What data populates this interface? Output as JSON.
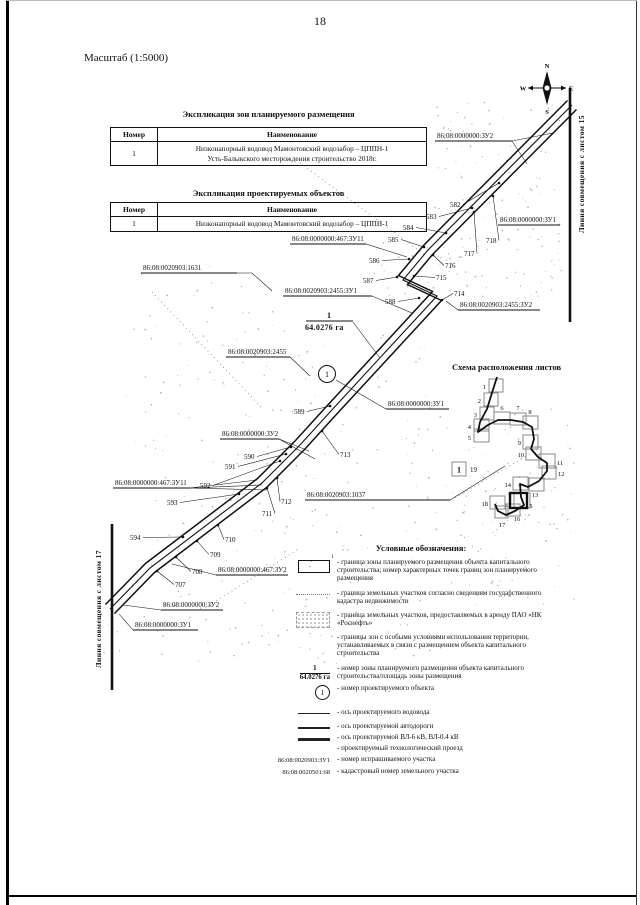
{
  "page": {
    "number": "18",
    "scale_label": "Масштаб (1:5000)",
    "paper": "#ffffff",
    "ink": "#111111"
  },
  "compass": {
    "n": "N",
    "s": "S",
    "w": "W",
    "e": "E"
  },
  "tables": [
    {
      "title": "Экспликация зон планируемого размещения",
      "headers": [
        "Номер",
        "Наименование"
      ],
      "rows": [
        {
          "num": "1",
          "name_lines": [
            "Низконапорный водовод Мамонтовский водозабор – ЦППН-1",
            "Усть-Балыкского месторождения строительство 2018г."
          ]
        }
      ]
    },
    {
      "title": "Экспликация проектируемых объектов",
      "headers": [
        "Номер",
        "Наименование"
      ],
      "rows": [
        {
          "num": "1",
          "name_lines": [
            "Низконапорный водовод Мамонтовский водозабор – ЦППН-1"
          ]
        }
      ]
    }
  ],
  "map": {
    "edge_right_label": "Линия совмещения с листом 15",
    "edge_left_label": "Линия совмещения с листом 17",
    "zone_number": "1",
    "zone_area": "64.0276 га",
    "object_number": "1",
    "pipeline_axis": [
      [
        572,
        105
      ],
      [
        428,
        250
      ],
      [
        403,
        280
      ],
      [
        437,
        296
      ],
      [
        330,
        412
      ],
      [
        300,
        445
      ],
      [
        262,
        483
      ],
      [
        150,
        568
      ],
      [
        110,
        609
      ]
    ],
    "points": [
      {
        "n": "582",
        "x": 450,
        "y": 207,
        "tx": 499,
        "ty": 183
      },
      {
        "n": "583",
        "x": 426,
        "y": 219,
        "tx": 472,
        "ty": 208
      },
      {
        "n": "584",
        "x": 403,
        "y": 230,
        "tx": 446,
        "ty": 233
      },
      {
        "n": "585",
        "x": 388,
        "y": 242,
        "tx": 424,
        "ty": 247
      },
      {
        "n": "586",
        "x": 369,
        "y": 263,
        "tx": 409,
        "ty": 259
      },
      {
        "n": "587",
        "x": 363,
        "y": 283,
        "tx": 397,
        "ty": 277
      },
      {
        "n": "588",
        "x": 385,
        "y": 304,
        "tx": 419,
        "ty": 298
      },
      {
        "n": "589",
        "x": 294,
        "y": 414,
        "tx": 330,
        "ty": 406
      },
      {
        "n": "590",
        "x": 244,
        "y": 459,
        "tx": 291,
        "ty": 447
      },
      {
        "n": "591",
        "x": 225,
        "y": 469,
        "tx": 286,
        "ty": 454
      },
      {
        "n": "592",
        "x": 200,
        "y": 488,
        "tx": 280,
        "ty": 461
      },
      {
        "n": "593",
        "x": 167,
        "y": 505,
        "tx": 239,
        "ty": 494
      },
      {
        "n": "594",
        "x": 130,
        "y": 540,
        "tx": 183,
        "ty": 537
      },
      {
        "n": "718",
        "x": 486,
        "y": 243,
        "tx": 493,
        "ty": 196
      },
      {
        "n": "717",
        "x": 464,
        "y": 256,
        "tx": 474,
        "ty": 212
      },
      {
        "n": "716",
        "x": 445,
        "y": 268,
        "tx": 433,
        "ty": 255
      },
      {
        "n": "715",
        "x": 436,
        "y": 280,
        "tx": 414,
        "ty": 276
      },
      {
        "n": "714",
        "x": 454,
        "y": 296,
        "tx": 442,
        "ty": 300
      },
      {
        "n": "713",
        "x": 340,
        "y": 457,
        "tx": 322,
        "ty": 431
      },
      {
        "n": "712",
        "x": 281,
        "y": 504,
        "tx": 277,
        "ty": 478
      },
      {
        "n": "711",
        "x": 262,
        "y": 516,
        "tx": 267,
        "ty": 488
      },
      {
        "n": "710",
        "x": 225,
        "y": 542,
        "tx": 218,
        "ty": 525
      },
      {
        "n": "709",
        "x": 210,
        "y": 557,
        "tx": 197,
        "ty": 541
      },
      {
        "n": "708",
        "x": 192,
        "y": 574,
        "tx": 176,
        "ty": 557
      },
      {
        "n": "707",
        "x": 175,
        "y": 587,
        "tx": 157,
        "ty": 571
      }
    ],
    "cad_labels": [
      {
        "t": "86:08:0000000:ЗУ2",
        "x": 437,
        "y": 138,
        "u": [
          435,
          141,
          512,
          141
        ],
        "leaders": [
          [
            [
              512,
              141
            ],
            [
              553,
              133
            ]
          ],
          [
            [
              512,
              141
            ],
            [
              527,
              164
            ]
          ]
        ]
      },
      {
        "t": "86:08:0000000:ЗУ1",
        "x": 500,
        "y": 222,
        "u": [
          498,
          225,
          560,
          225
        ],
        "leaders": []
      },
      {
        "t": "86:08:0000000:467:ЗУ11",
        "x": 292,
        "y": 241,
        "u": [
          290,
          244,
          366,
          244
        ],
        "leaders": [
          [
            [
              366,
              244
            ],
            [
              407,
              257
            ]
          ]
        ]
      },
      {
        "t": "86:08:0020903:1631",
        "x": 143,
        "y": 270,
        "u": [
          141,
          273,
          237,
          273
        ],
        "leaders": [
          [
            [
              237,
              273
            ],
            [
              252,
              273
            ],
            [
              272,
              291
            ]
          ]
        ]
      },
      {
        "t": "86:08:0020903:2455:ЗУ1",
        "x": 285,
        "y": 293,
        "u": [
          283,
          296,
          372,
          296
        ],
        "leaders": [
          [
            [
              372,
              296
            ],
            [
              412,
              313
            ]
          ]
        ]
      },
      {
        "t": "86:08:0020903:2455:ЗУ2",
        "x": 460,
        "y": 307,
        "u": [
          458,
          310,
          540,
          310
        ],
        "leaders": [
          [
            [
              458,
              310
            ],
            [
              446,
              301
            ]
          ]
        ]
      },
      {
        "t": "86:08:0020903:2455",
        "x": 228,
        "y": 354,
        "u": [
          226,
          357,
          290,
          357
        ],
        "leaders": [
          [
            [
              290,
              357
            ],
            [
              310,
              376
            ]
          ]
        ]
      },
      {
        "t": "86:08:0000000:ЗУ1",
        "x": 388,
        "y": 406,
        "u": [
          386,
          409,
          449,
          409
        ],
        "leaders": [
          [
            [
              386,
              409
            ],
            [
              336,
              380
            ]
          ]
        ]
      },
      {
        "t": "86:08:0000000:ЗУ2",
        "x": 222,
        "y": 436,
        "u": [
          220,
          439,
          279,
          439
        ],
        "leaders": [
          [
            [
              279,
              439
            ],
            [
              309,
              451
            ]
          ],
          [
            [
              279,
              439
            ],
            [
              315,
              459
            ]
          ]
        ]
      },
      {
        "t": "86:08:0020903:1037",
        "x": 307,
        "y": 497,
        "u": [
          305,
          500,
          450,
          500
        ],
        "leaders": [
          [
            [
              450,
              500
            ],
            [
              505,
              466
            ]
          ]
        ]
      },
      {
        "t": "86:08:0000000:467:ЗУ11",
        "x": 115,
        "y": 485,
        "u": [
          113,
          488,
          190,
          488
        ],
        "leaders": [
          [
            [
              190,
              488
            ],
            [
              257,
              480
            ]
          ],
          [
            [
              190,
              488
            ],
            [
              262,
              485
            ]
          ],
          [
            [
              190,
              488
            ],
            [
              267,
              490
            ]
          ]
        ]
      },
      {
        "t": "86:08:0000000:467:ЗУ2",
        "x": 218,
        "y": 572,
        "u": [
          216,
          575,
          288,
          575
        ],
        "leaders": [
          [
            [
              216,
              575
            ],
            [
              172,
              564
            ]
          ]
        ]
      },
      {
        "t": "86:08:0000000:ЗУ2",
        "x": 163,
        "y": 607,
        "u": [
          161,
          610,
          223,
          610
        ],
        "leaders": [
          [
            [
              161,
              610
            ],
            [
              123,
              605
            ]
          ]
        ]
      },
      {
        "t": "86:08:0000000:ЗУ1",
        "x": 135,
        "y": 627,
        "u": [
          133,
          630,
          198,
          630
        ],
        "leaders": [
          [
            [
              133,
              630
            ],
            [
              119,
              614
            ]
          ]
        ]
      }
    ],
    "fraction_pos": {
      "nx": 329,
      "ny": 318,
      "bar": [
        306,
        321,
        353,
        321
      ],
      "dx": 305,
      "dy": 330,
      "leader": [
        [
          353,
          322
        ],
        [
          380,
          358
        ]
      ]
    },
    "object_circle": {
      "cx": 327,
      "cy": 374,
      "r": 8.5
    },
    "speckle_regions": [
      [
        432,
        100,
        130,
        200,
        120
      ],
      [
        370,
        240,
        90,
        60,
        25
      ],
      [
        125,
        260,
        160,
        210,
        70
      ],
      [
        255,
        335,
        175,
        150,
        60
      ],
      [
        395,
        405,
        180,
        200,
        100
      ],
      [
        145,
        475,
        230,
        170,
        80
      ],
      [
        95,
        612,
        360,
        55,
        45
      ],
      [
        455,
        505,
        100,
        45,
        22
      ]
    ],
    "dotted_lines": [
      [
        [
          300,
          163
        ],
        [
          425,
          255
        ]
      ],
      [
        [
          152,
          292
        ],
        [
          262,
          408
        ]
      ],
      [
        [
          455,
          498
        ],
        [
          540,
          448
        ]
      ],
      [
        [
          205,
          608
        ],
        [
          300,
          548
        ]
      ]
    ],
    "edge_right_line": [
      570,
      88,
      570,
      322
    ],
    "edge_left_line": [
      112,
      524,
      112,
      690
    ]
  },
  "scheme": {
    "title": "Схема расположения листов",
    "sheets": [
      {
        "n": "1",
        "x": 489,
        "y": 379,
        "w": 14,
        "h": 13,
        "lx": 486,
        "ly": 389,
        "a": "end"
      },
      {
        "n": "2",
        "x": 484,
        "y": 393,
        "w": 14,
        "h": 13,
        "lx": 481,
        "ly": 403,
        "a": "end"
      },
      {
        "n": "3",
        "x": 480,
        "y": 407,
        "w": 14,
        "h": 13,
        "lx": 477,
        "ly": 417,
        "a": "end"
      },
      {
        "n": "4",
        "x": 474,
        "y": 419,
        "w": 15,
        "h": 12,
        "lx": 471,
        "ly": 429,
        "a": "end"
      },
      {
        "n": "5",
        "x": 474,
        "y": 429,
        "w": 15,
        "h": 13,
        "lx": 471,
        "ly": 440,
        "a": "end"
      },
      {
        "n": "6",
        "x": 494,
        "y": 412,
        "w": 16,
        "h": 12,
        "lx": 502,
        "ly": 410,
        "a": "middle"
      },
      {
        "n": "7",
        "x": 510,
        "y": 413,
        "w": 16,
        "h": 12,
        "lx": 518,
        "ly": 410,
        "a": "middle"
      },
      {
        "n": "8",
        "x": 523,
        "y": 416,
        "w": 15,
        "h": 13,
        "lx": 530,
        "ly": 414,
        "a": "middle"
      },
      {
        "n": "9",
        "x": 523,
        "y": 435,
        "w": 15,
        "h": 14,
        "lx": 521,
        "ly": 445,
        "a": "end"
      },
      {
        "n": "10",
        "x": 526,
        "y": 447,
        "w": 15,
        "h": 13,
        "lx": 524,
        "ly": 457,
        "a": "end"
      },
      {
        "n": "11",
        "x": 539,
        "y": 454,
        "w": 16,
        "h": 14,
        "lx": 557,
        "ly": 465,
        "a": "start"
      },
      {
        "n": "12",
        "x": 542,
        "y": 466,
        "w": 14,
        "h": 13,
        "lx": 558,
        "ly": 476,
        "a": "start"
      },
      {
        "n": "13",
        "x": 529,
        "y": 478,
        "w": 15,
        "h": 13,
        "lx": 535,
        "ly": 497,
        "a": "middle"
      },
      {
        "n": "14",
        "x": 513,
        "y": 477,
        "w": 15,
        "h": 13,
        "lx": 511,
        "ly": 487,
        "a": "end"
      },
      {
        "n": "15",
        "x": 514,
        "y": 493,
        "w": 16,
        "h": 15,
        "lx": 526,
        "ly": 508,
        "a": "start"
      },
      {
        "n": "16",
        "x": 506,
        "y": 504,
        "w": 14,
        "h": 12,
        "lx": 517,
        "ly": 521,
        "a": "middle"
      },
      {
        "n": "17",
        "x": 495,
        "y": 506,
        "w": 13,
        "h": 12,
        "lx": 502,
        "ly": 527,
        "a": "middle"
      },
      {
        "n": "18",
        "x": 490,
        "y": 496,
        "w": 15,
        "h": 13,
        "lx": 488,
        "ly": 506,
        "a": "end"
      }
    ],
    "bold_box": {
      "x": 510,
      "y": 493,
      "w": 17,
      "h": 15
    },
    "route": [
      [
        497,
        377
      ],
      [
        491,
        396
      ],
      [
        487,
        409
      ],
      [
        480,
        422
      ],
      [
        478,
        432
      ],
      [
        488,
        425
      ],
      [
        498,
        420
      ],
      [
        511,
        420
      ],
      [
        523,
        422
      ],
      [
        532,
        427
      ],
      [
        534,
        439
      ],
      [
        531,
        449
      ],
      [
        538,
        457
      ],
      [
        547,
        463
      ],
      [
        547,
        471
      ],
      [
        539,
        481
      ],
      [
        528,
        487
      ],
      [
        520,
        484
      ],
      [
        521,
        497
      ],
      [
        524,
        505
      ],
      [
        515,
        511
      ],
      [
        506,
        515
      ],
      [
        498,
        511
      ],
      [
        495,
        504
      ]
    ],
    "legend_box": {
      "x": 452,
      "y": 462,
      "w": 14,
      "h": 14,
      "mark": "1",
      "label": "19"
    }
  },
  "legend": {
    "title": "Условные обозначения:",
    "items": [
      {
        "sym": "zone",
        "text": "граница зоны планируемого размещения объекта капитального строительства; номер характерных точек границ зон планируемого размещения",
        "mb": 8
      },
      {
        "sym": "dots",
        "text": "граница земельных участков согласно сведениям государственного кадастра недвижимости",
        "mb": 6
      },
      {
        "sym": "speckle",
        "text": "граница земельных участков, предоставляемых в аренду ПАО «НК «Роснефть»",
        "mb": 6
      },
      {
        "sym": "none",
        "text": "границы зон с особыми условиями использования территории, устанавливаемых в связи с размещением объекта капитального строительства",
        "mb": 8
      },
      {
        "sym": "frac",
        "text": "номер зоны планируемого размещения объекта капитального строительства/площадь зоны размещения",
        "mb": 4
      },
      {
        "sym": "circ",
        "text": "номер проектируемого объекта",
        "mb": 9
      },
      {
        "sym": "line thin",
        "text": "ось проектируемого водовода",
        "mb": 6
      },
      {
        "sym": "line med",
        "text": "ось проектируемой автодороги",
        "mb": 3
      },
      {
        "sym": "line thick",
        "text": "ось проектируемой ВЛ-6 кВ, ВЛ-0.4 кВ",
        "mb": 3
      },
      {
        "sym": "none",
        "text": "проектируемый технологический проезд",
        "mb": 3
      },
      {
        "sym": "code",
        "code": "86:08:0020903:ЗУ1",
        "text": "номер испрашиваемого участка",
        "mb": 4
      },
      {
        "sym": "code",
        "code": "86:08:0020501:68",
        "text": "кадастровый номер земельного участка",
        "mb": 0
      }
    ]
  }
}
